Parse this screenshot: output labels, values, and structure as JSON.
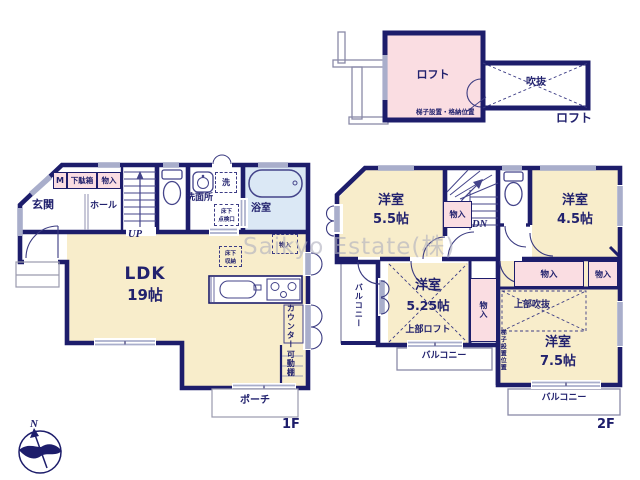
{
  "watermark": {
    "text": "Saikyo Estate(株)"
  },
  "colors": {
    "wall": "#1d1d6b",
    "room_cream": "#f8edcb",
    "pink": "#fadde2",
    "bath_blue": "#dbe8f5",
    "window_gray": "#a9aecb",
    "text": "#22226e",
    "watermark": "#b0b0be"
  },
  "compass": {
    "north": "N"
  },
  "loft_plan": {
    "room_label": "ロフト",
    "void_label": "吹抜",
    "ladder_note": "梯子設置・格納位置",
    "floor_label": "ロフト"
  },
  "floor1": {
    "floor_label": "1F",
    "entrance": "玄関",
    "hall": "ホール",
    "meter_box": "M",
    "shoe_box": "下駄箱",
    "storage_top": "物入",
    "up": "UP",
    "washroom": "洗面所",
    "washer": "洗",
    "underfloor_hatch_l1": "床下",
    "underfloor_hatch_l2": "点検口",
    "bath": "浴室",
    "storage_dashed": "物入",
    "underfloor_storage_l1": "床下",
    "underfloor_storage_l2": "収納",
    "ldk_name": "LDK",
    "ldk_size": "19帖",
    "counter": "カウンター",
    "movable_shelf": "可動棚",
    "porch": "ポーチ"
  },
  "floor2": {
    "floor_label": "2F",
    "dn": "DN",
    "room_nw_name": "洋室",
    "room_nw_size": "5.5帖",
    "room_ne_name": "洋室",
    "room_ne_size": "4.5帖",
    "room_mid_name": "洋室",
    "room_mid_size": "5.25帖",
    "room_se_name": "洋室",
    "room_se_size": "7.5帖",
    "storage_stairs": "物入",
    "storage_band_1": "物入",
    "storage_band_2": "物入",
    "storage_mid": "物入",
    "upper_loft": "上部ロフト",
    "upper_void": "上部吹抜",
    "ladder_pos": "梯子設置位置",
    "balcony_west": "バルコニー",
    "balcony_south": "バルコニー",
    "balcony_se": "バルコニー"
  }
}
